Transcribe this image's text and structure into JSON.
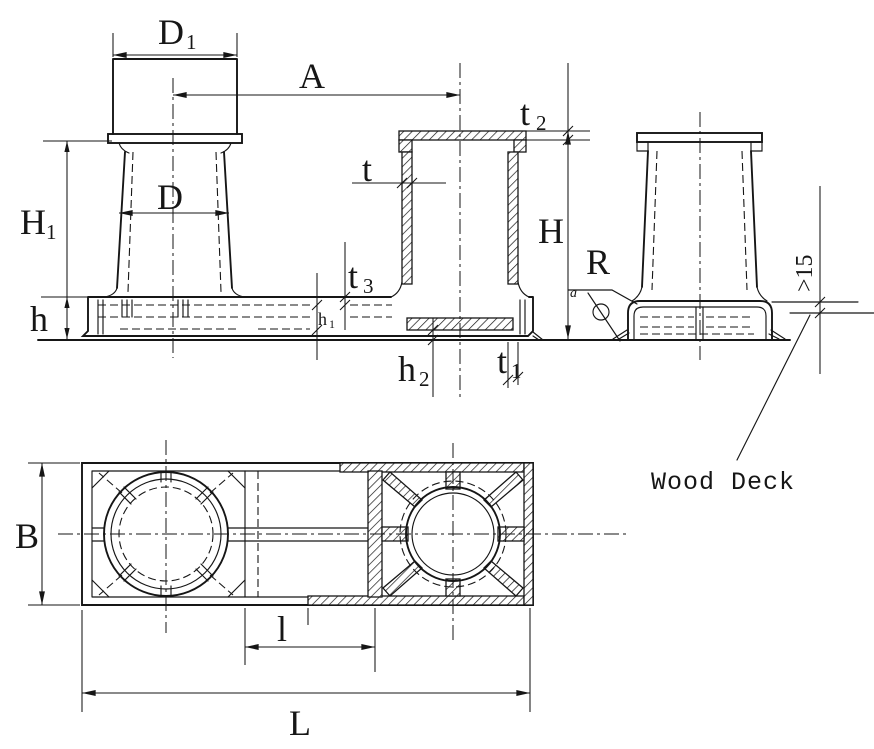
{
  "drawing": {
    "type": "double-bollard-technical-drawing",
    "colors": {
      "line": "#161616",
      "background": "#ffffff"
    },
    "labels": {
      "d1": {
        "main": "D",
        "sub": "1"
      },
      "a_spacing": "A",
      "t2": {
        "main": "t",
        "sub": "2"
      },
      "t": "t",
      "d": "D",
      "h1_height": {
        "main": "H",
        "sub": "1"
      },
      "h_height": "H",
      "h_base": "h",
      "t3": {
        "main": "t",
        "sub": "3"
      },
      "h1_small": {
        "main": "h",
        "sub": "1"
      },
      "h2": {
        "main": "h",
        "sub": "2"
      },
      "t1": {
        "main": "t",
        "sub": "1"
      },
      "r_radius": "R",
      "a_weld": "a",
      "deck_min": ">15",
      "wood_deck": "Wood Deck",
      "b_width": "B",
      "l_spacing": "l",
      "l_length": "L"
    }
  }
}
